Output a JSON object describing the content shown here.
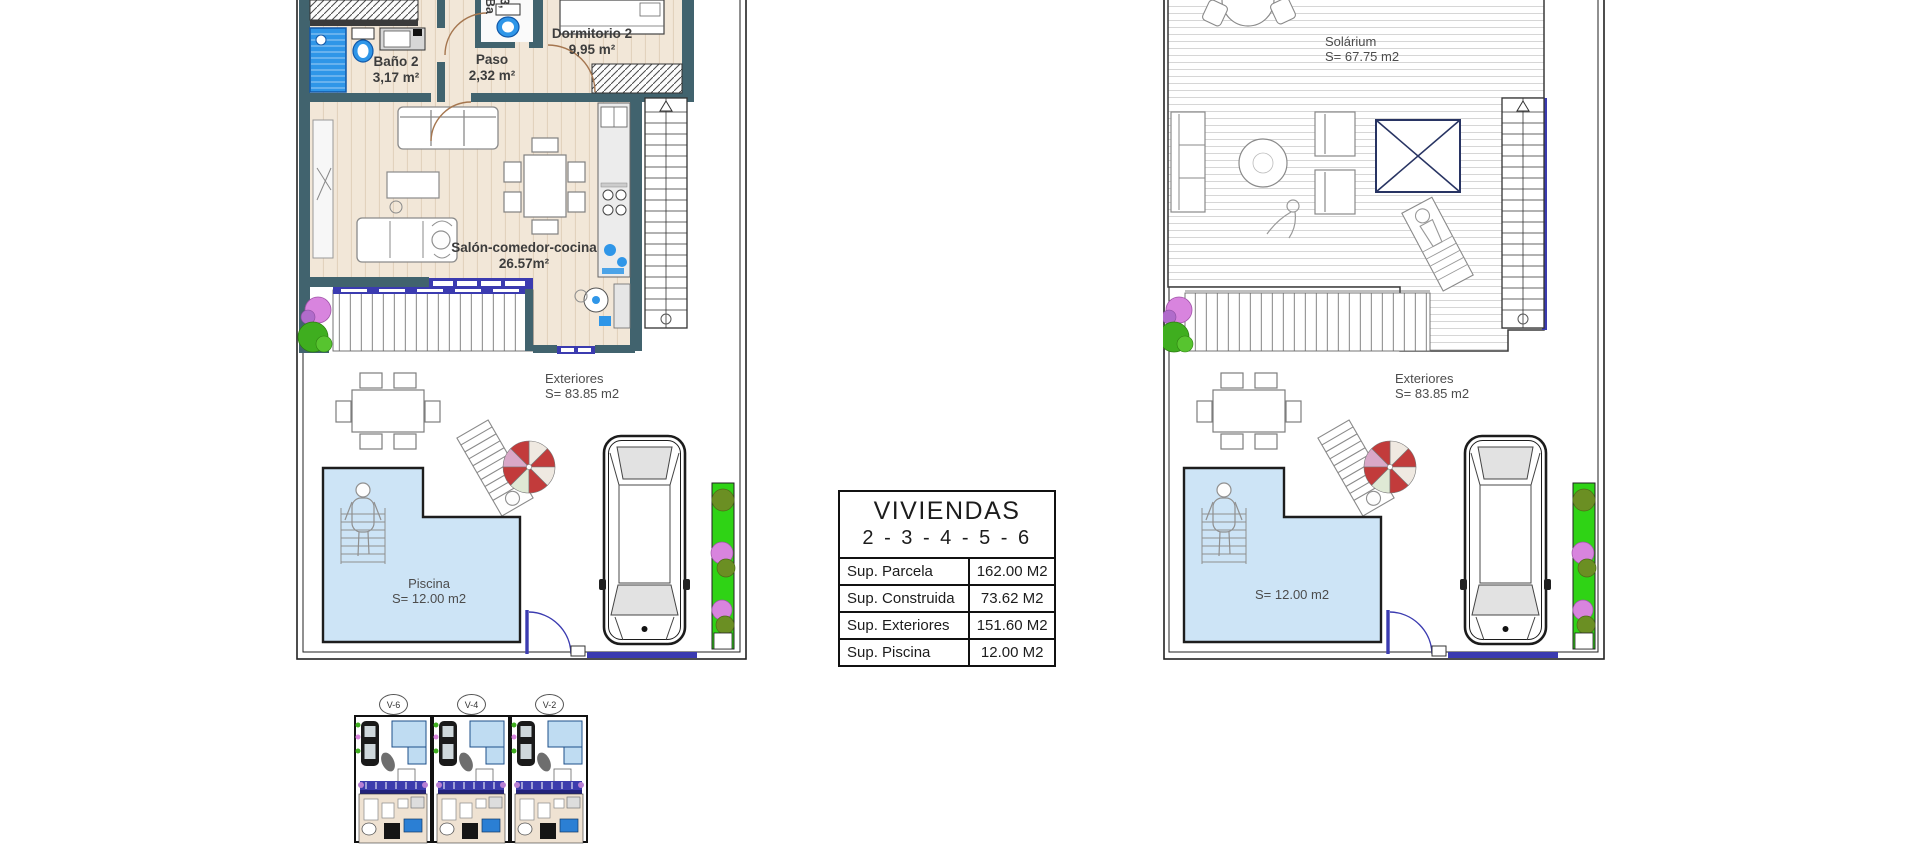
{
  "sheet": {
    "background": "#ffffff",
    "plans": {
      "ground_floor": {
        "rooms": {
          "bano2": {
            "name": "Baño 2",
            "area": "3,17 m²"
          },
          "paso": {
            "name": "Paso",
            "area": "2,32 m²"
          },
          "bano3_partial": {
            "name": "Ba",
            "area": "3,"
          },
          "dormitorio2": {
            "name": "Dormitorio 2",
            "area": "9,95 m²"
          },
          "salon": {
            "name": "Salón-comedor-cocina",
            "area": "26.57m²"
          },
          "exteriores": {
            "name": "Exteriores",
            "area": "S= 83.85 m2"
          },
          "piscina": {
            "name": "Piscina",
            "area": "S= 12.00 m2"
          }
        }
      },
      "solarium_floor": {
        "rooms": {
          "solarium": {
            "name": "Solárium",
            "area": "S= 67.75 m2"
          },
          "exteriores": {
            "name": "Exteriores",
            "area": "S= 83.85 m2"
          },
          "piscina": {
            "area": "S= 12.00 m2"
          }
        }
      }
    },
    "spec_table": {
      "title": "VIVIENDAS",
      "subtitle": "2 - 3 - 4 - 5 - 6",
      "rows": [
        {
          "label": "Sup. Parcela",
          "value": "162.00 M2"
        },
        {
          "label": "Sup. Construida",
          "value": "73.62 M2"
        },
        {
          "label": "Sup. Exteriores",
          "value": "151.60 M2"
        },
        {
          "label": "Sup. Piscina",
          "value": "12.00 M2"
        }
      ]
    },
    "site_thumbnails": [
      {
        "label": "V-6"
      },
      {
        "label": "V-4"
      },
      {
        "label": "V-2"
      }
    ],
    "colors": {
      "wall": "#41636e",
      "floor": "#f2e7d8",
      "water": "#cde4f6",
      "fixture_blue": "#2f96e8",
      "gate_blue": "#3b3bb0",
      "hedge_green": "#2fd315",
      "bush_pink": "#d884de",
      "bush_green": "#3fae1f",
      "umbrella_red": "#c23b3b"
    }
  }
}
